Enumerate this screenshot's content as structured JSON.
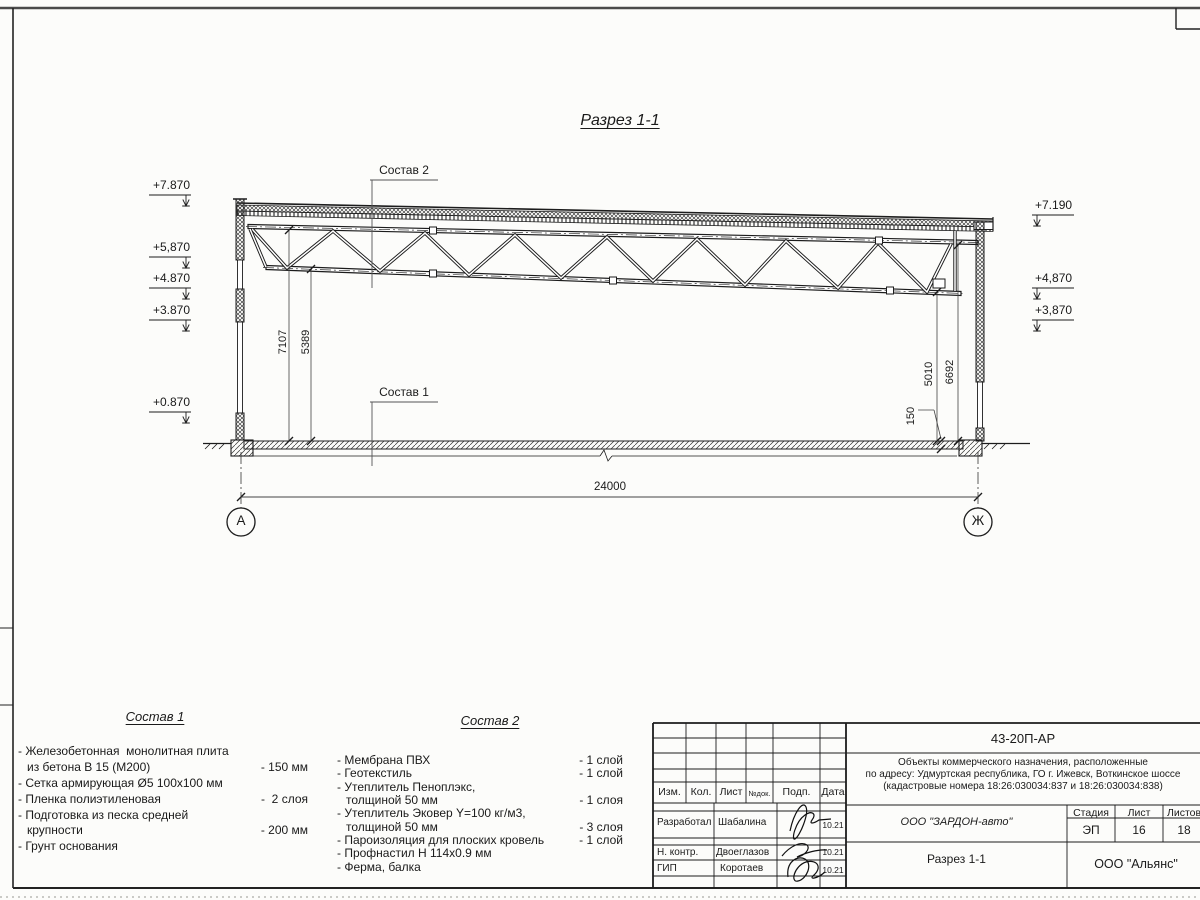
{
  "sheet": {
    "section_title": "Разрез 1-1",
    "span_label": "24000",
    "axis_left": "А",
    "axis_right": "Ж",
    "callout1": "Состав 1",
    "callout2": "Состав 2",
    "elev_left": [
      "+7.870",
      "+5,870",
      "+4.870",
      "+3.870",
      "+0.870"
    ],
    "elev_right": [
      "+7.190",
      "+4,870",
      "+3,870"
    ],
    "dim_7107": "7107",
    "dim_5389": "5389",
    "dim_5010": "5010",
    "dim_6692": "6692",
    "dim_150": "150"
  },
  "sostav1": {
    "title": "Состав 1",
    "rows": [
      {
        "t": "- Железобетонная  монолитная плита",
        "v": ""
      },
      {
        "t": "из бетона В 15 (М200)",
        "v": "- 150 мм"
      },
      {
        "t": "- Сетка армирующая Ø5 100х100 мм",
        "v": ""
      },
      {
        "t": "- Пленка полиэтиленовая",
        "v": "-  2 слоя"
      },
      {
        "t": "- Подготовка из песка средней",
        "v": ""
      },
      {
        "t": "крупности",
        "v": "- 200 мм"
      },
      {
        "t": "- Грунт основания",
        "v": ""
      }
    ]
  },
  "sostav2": {
    "title": "Состав 2",
    "rows": [
      {
        "t": "- Мембрана ПВХ",
        "v": "- 1 слой"
      },
      {
        "t": "- Геотекстиль",
        "v": "- 1 слой"
      },
      {
        "t": "- Утеплитель Пеноплэкс,",
        "v": ""
      },
      {
        "t": "толщиной 50 мм",
        "v": "- 1 слоя"
      },
      {
        "t": "- Утеплитель Эковер Y=100 кг/м3,",
        "v": ""
      },
      {
        "t": "толщиной 50 мм",
        "v": "- 3 слоя"
      },
      {
        "t": "- Пароизоляция для плоских кровель",
        "v": "- 1 слой"
      },
      {
        "t": "- Профнастил Н 114х0.9 мм",
        "v": ""
      },
      {
        "t": "- Ферма, балка",
        "v": ""
      }
    ]
  },
  "titleblock": {
    "doc_number": "43-20П-АР",
    "project_line1": "Объекты коммерческого назначения, расположенные",
    "project_line2": "по адресу: Удмуртская республика, ГО г. Ижевск, Воткинское шоссе",
    "project_line3": "(кадастровые номера 18:26:030034:837 и 18:26:030034:838)",
    "col_izm": "Изм.",
    "col_kol": "Кол.",
    "col_list": "Лист",
    "col_ndok": "№док.",
    "col_podp": "Подп.",
    "col_data": "Дата",
    "row1_role": "Разработал",
    "row1_name": "Шабалина",
    "row1_date": "10.21",
    "row2_role": "Н. контр.",
    "row2_name": "Двоеглазов",
    "row2_date": "10.21",
    "row3_role": "ГИП",
    "row3_name": "Коротаев",
    "row3_date": "10.21",
    "company": "ООО \"ЗАРДОН-авто\"",
    "stage_label": "Стадия",
    "sheet_label": "Лист",
    "sheets_label": "Листов",
    "stage": "ЭП",
    "sheet_num": "16",
    "sheets_total": "18",
    "drawing_name": "Разрез 1-1",
    "org": "ООО \"Альянс\""
  }
}
